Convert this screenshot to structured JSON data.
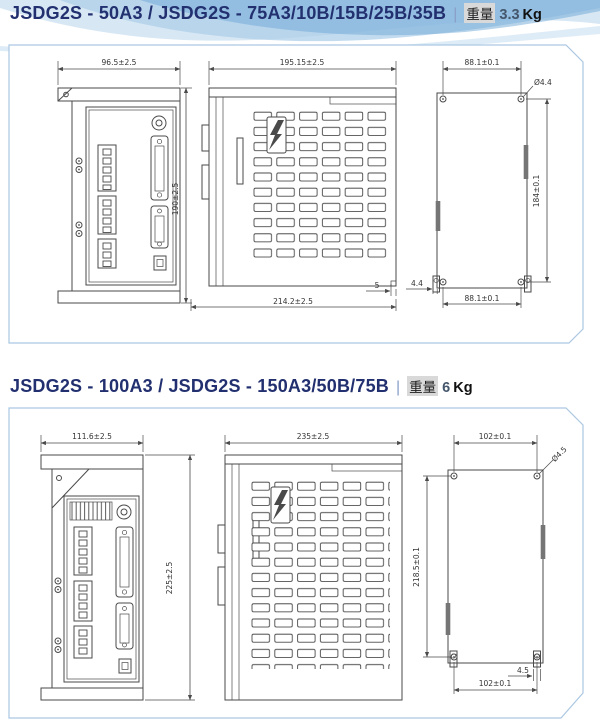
{
  "sections": [
    {
      "title": "JSDG2S - 50A3 / JSDG2S - 75A3/10B/15B/25B/35B",
      "divider": "|",
      "weight_label": "重量",
      "weight_value": "3.3",
      "weight_unit": "Kg",
      "dims": {
        "front_width": "96.5±2.5",
        "front_height": "190±2.5",
        "side_depth": "195.15±2.5",
        "side_total_depth": "214.2±2.5",
        "side_step": "5",
        "back_hole_span_top": "88.1±0.1",
        "back_hole_dia": "Ø4.4",
        "back_hole_height": "184±0.1",
        "back_foot_offset": "4.4",
        "back_hole_span_bottom": "88.1±0.1"
      }
    },
    {
      "title": "JSDG2S - 100A3 / JSDG2S - 150A3/50B/75B",
      "divider": "|",
      "weight_label": "重量",
      "weight_value": "6",
      "weight_unit": "Kg",
      "dims": {
        "front_width": "111.6±2.5",
        "front_height": "225±2.5",
        "side_depth": "235±2.5",
        "back_hole_span_top": "102±0.1",
        "back_hole_dia": "Ø4.5",
        "back_hole_height": "218.5±0.1",
        "back_foot_offset": "4.5",
        "back_hole_span_bottom": "102±0.1"
      }
    }
  ],
  "colors": {
    "title": "#223070",
    "panel_border": "#abc8e2",
    "drawing_line": "#4a4a4a",
    "wave_light": "#d7e7f4",
    "wave_mid": "#aecfe9",
    "wave_deep": "#6ea8d6"
  }
}
